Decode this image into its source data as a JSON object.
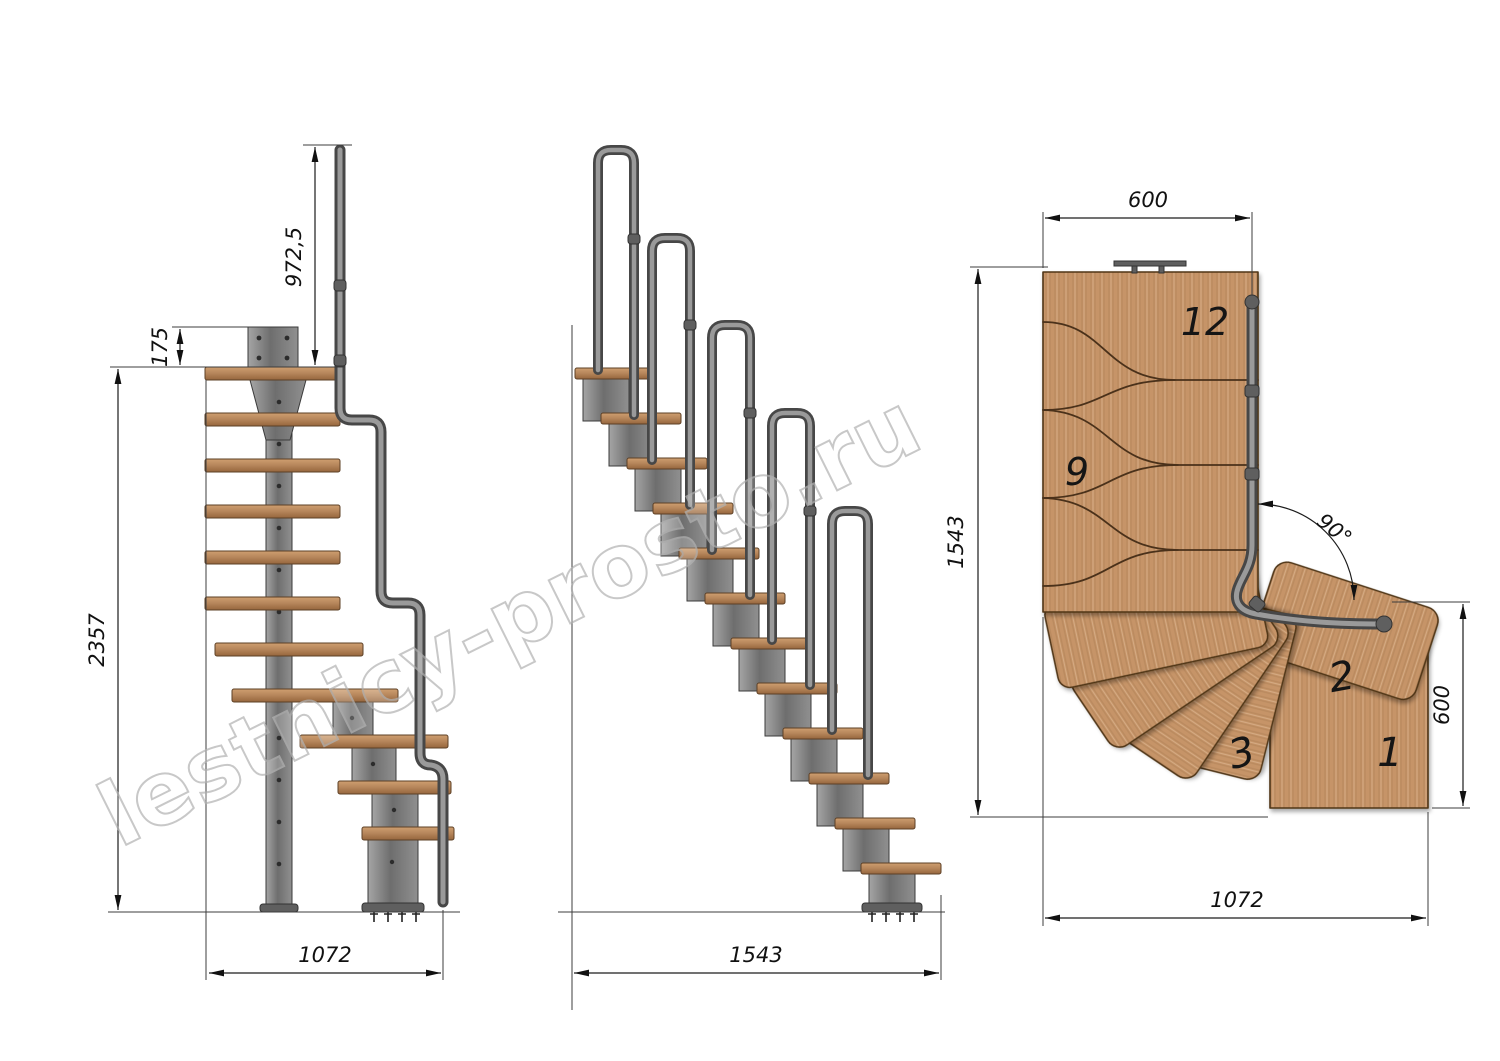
{
  "drawing": {
    "title": "Modular L-turn staircase technical drawing",
    "watermark": "lestnicy-prosto.ru",
    "side_view": {
      "dim_handrail_height": "972,5",
      "dim_top_offset": "175",
      "dim_total_height": "2357",
      "dim_length": "1072"
    },
    "front_view": {
      "dim_width": "1543"
    },
    "plan_view": {
      "dim_top_width": "600",
      "dim_side_length": "1543",
      "dim_angle": "90°",
      "dim_step_width": "600",
      "dim_bottom_length": "1072",
      "step12": "12",
      "step9": "9",
      "step2": "2",
      "step3": "3",
      "step1": "1"
    }
  },
  "colors": {
    "background": "#ffffff",
    "wood_light": "#cf9f70",
    "wood_dark": "#9a6b41",
    "metal": "#8c8c8c",
    "metal_dark": "#474747",
    "line": "#1c1c1c",
    "watermark": "#b3b3b3"
  }
}
